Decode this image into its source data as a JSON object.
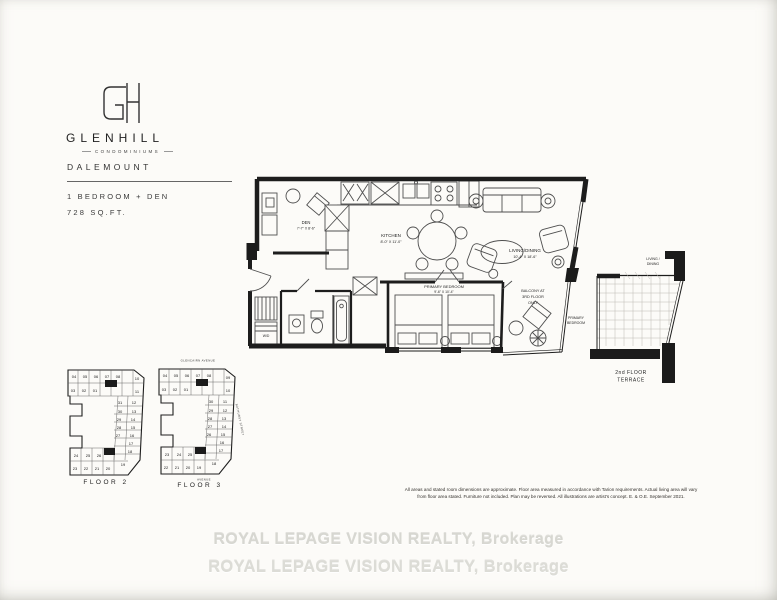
{
  "brand": {
    "monogram": "GH",
    "name": "GLENHILL",
    "tagline": "CONDOMINIUMS"
  },
  "unit": {
    "name": "DALEMOUNT",
    "type_line": "1 BEDROOM + DEN",
    "area_line": "728 SQ.FT."
  },
  "plan": {
    "den": {
      "name": "DEN",
      "dims": "7'-7\" X 8'-6\""
    },
    "kitchen": {
      "name": "KITCHEN",
      "dims": "8'-0\" X 11'-0\""
    },
    "living": {
      "name": "LIVING/DINING",
      "dims": "10'-4\" X 18'-6\""
    },
    "bedroom": {
      "name": "PRIMARY BEDROOM",
      "dims": "9'-6\" X 10'-4\""
    },
    "balcony": {
      "l1": "BALCONY AT",
      "l2": "3RD FLOOR",
      "l3": "ONLY"
    },
    "laundry": "W/D"
  },
  "terrace": {
    "adjacent_top_l1": "LIVING /",
    "adjacent_top_l2": "DINING",
    "adjacent_left_l1": "PRIMARY",
    "adjacent_left_l2": "BEDROOM",
    "label_l1": "2nd FLOOR",
    "label_l2": "TERRACE"
  },
  "keyplans": {
    "floor2": {
      "label": "FLOOR 2",
      "units": [
        "04",
        "05",
        "06",
        "07",
        "08",
        "10",
        "03",
        "02",
        "01",
        "11",
        "31",
        "12",
        "30",
        "13",
        "29",
        "14",
        "28",
        "15",
        "27",
        "16",
        "17",
        "18",
        "24",
        "25",
        "26",
        "23",
        "22",
        "21",
        "20",
        "19"
      ]
    },
    "floor3": {
      "label": "FLOOR 3",
      "street_top": "GLENCAIRN AVENUE",
      "street_right": "BATHURST STREET",
      "street_bottom": "AVENUE",
      "units": [
        "04",
        "05",
        "06",
        "07",
        "08",
        "09",
        "03",
        "02",
        "01",
        "10",
        "30",
        "11",
        "29",
        "12",
        "28",
        "13",
        "27",
        "14",
        "26",
        "15",
        "16",
        "17",
        "23",
        "24",
        "25",
        "22",
        "21",
        "20",
        "19",
        "18"
      ]
    }
  },
  "disclaimer": {
    "l1": "All areas and stated room dimensions are approximate. Floor area measured in accordance with Tarion requirements. Actual living area will vary",
    "l2": "from floor area stated. Furniture not included. Plan may be reversed. All illustrations are artist's concept. E. & O.E. September 2021."
  },
  "watermark": {
    "l1": "ROYAL LEPAGE VISION REALTY, Brokerage",
    "l2": "ROYAL LEPAGE VISION REALTY, Brokerage"
  }
}
